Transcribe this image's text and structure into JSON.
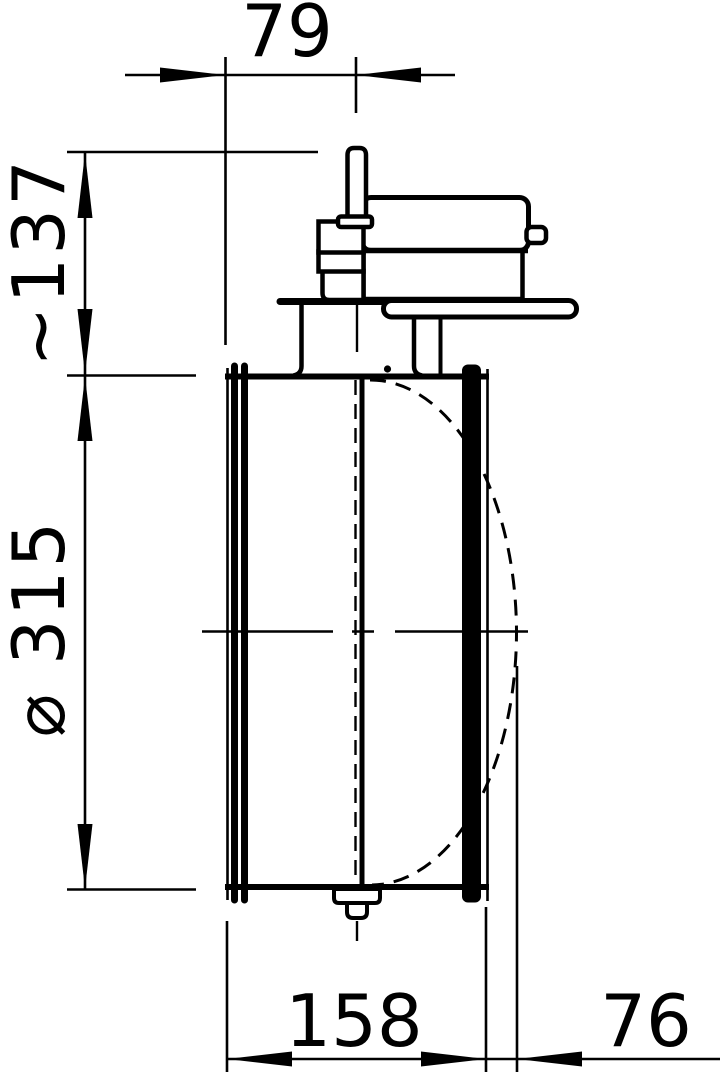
{
  "page": {
    "background": "#ffffff",
    "line_color": "#000000"
  },
  "drawing": {
    "description": "side-view technical drawing of circular duct damper with actuator",
    "dimensions": {
      "top_width": "79",
      "height_to_spindle": "~137",
      "diameter": "⌀ 315",
      "body_length": "158",
      "side_extension": "76"
    }
  }
}
